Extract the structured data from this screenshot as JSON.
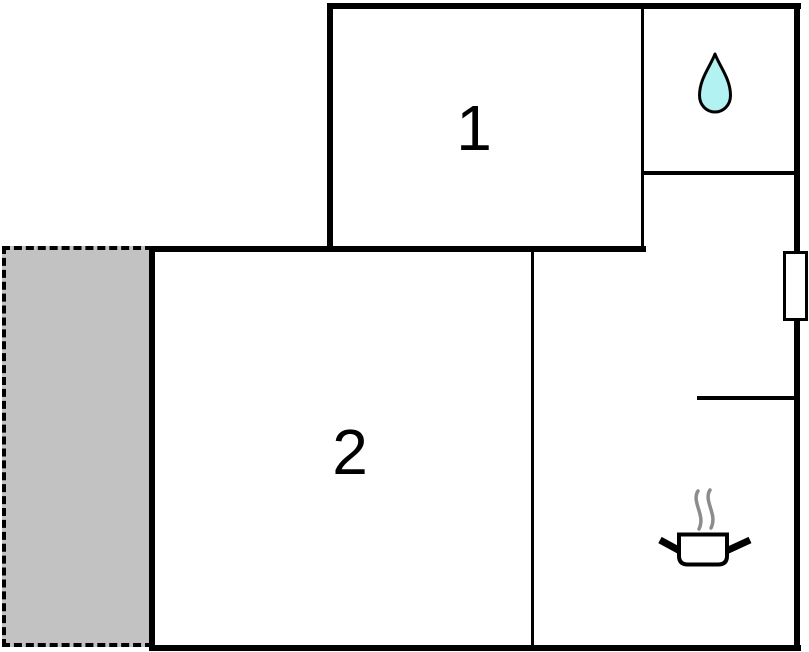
{
  "floorplan": {
    "type": "floor-plan",
    "background_color": "#ffffff",
    "wall_color": "#000000",
    "rooms": [
      {
        "label": "1"
      },
      {
        "label": "2"
      }
    ],
    "icons": [
      {
        "name": "water-drop-icon",
        "fill": "#b2f2f2",
        "stroke": "#000000"
      },
      {
        "name": "cooking-pot-icon",
        "fill": "#ffffff",
        "stroke": "#000000",
        "steam_color": "#8c8c8c"
      }
    ],
    "terrace": {
      "fill": "#c2c2c2",
      "border_color": "#000000",
      "border_style": "dashed"
    },
    "window_marker": {
      "fill": "#ffffff",
      "border_color": "#000000"
    }
  }
}
